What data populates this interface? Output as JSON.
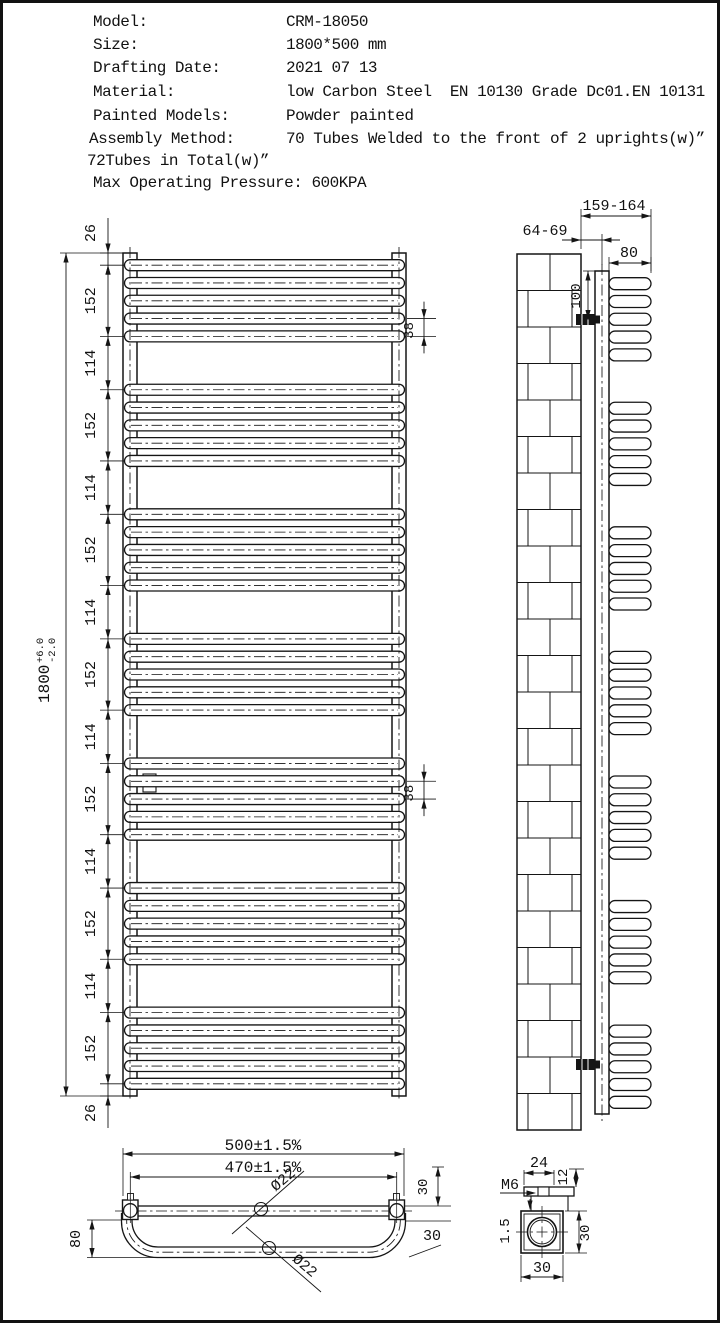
{
  "header": {
    "rows": [
      {
        "label": "Model:",
        "value": "CRM-18050"
      },
      {
        "label": "Size:",
        "value": "1800*500 mm"
      },
      {
        "label": "Drafting Date:",
        "value": "2021 07 13"
      },
      {
        "label": "Material:",
        "value": "low Carbon Steel  EN 10130 Grade Dc01.EN 10131"
      },
      {
        "label": "Painted Models:",
        "value": "Powder painted"
      },
      {
        "label": "Assembly Method:",
        "value": "70 Tubes Welded to the front of 2 uprights(w)”"
      }
    ],
    "note": "72Tubes in Total(w)”",
    "pressure_label": "Max Operating Pressure:",
    "pressure_value": "600KPA"
  },
  "front_view": {
    "overall_value": "1800",
    "tol_plus": "+6.0",
    "tol_minus": "-2.0",
    "chain": [
      "26",
      "152",
      "114",
      "152",
      "114",
      "152",
      "114",
      "152",
      "114",
      "152",
      "114",
      "152",
      "114",
      "152",
      "26"
    ],
    "tube_pitch": "38",
    "groups": 7,
    "tubes_per_group": 5
  },
  "side_view": {
    "wall_to_tube_front": "159-164",
    "wall_to_upright": "64-69",
    "tube_depth": "80",
    "bracket_offset": "100"
  },
  "plan_view": {
    "overall_width": "500±1.5%",
    "upright_centers": "470±1.5%",
    "tube_dia_straight": "Ø22",
    "tube_dia_curved": "Ø22",
    "loop_depth": "80",
    "dim_30_top": "30",
    "dim_30_bottom": "30"
  },
  "detail_view": {
    "bracket_width": "24",
    "hook_height": "12",
    "thread": "M6",
    "wall_thickness": "1.5",
    "square_height": "30",
    "square_width": "30"
  },
  "line_color": "#151515"
}
